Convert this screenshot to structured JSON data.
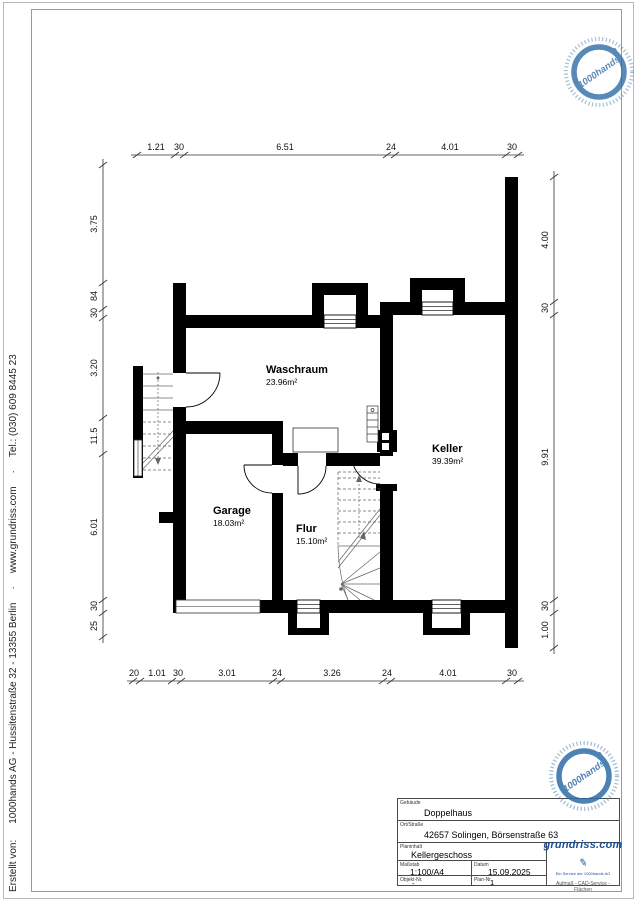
{
  "credit": {
    "prefix": "Erstellt von:",
    "company": "1000hands AG - Hussitenstraße 32 - 13355 Berlin",
    "sep": "·",
    "website": "www.grundriss.com",
    "phone": "Tel.: (030) 609 8445 23"
  },
  "rooms": [
    {
      "name": "Waschraum",
      "area": "23.96m²"
    },
    {
      "name": "Keller",
      "area": "39.39m²"
    },
    {
      "name": "Garage",
      "area": "18.03m²"
    },
    {
      "name": "Flur",
      "area": "15.10m²"
    }
  ],
  "dims": {
    "top": [
      "1.21",
      "30",
      "6.51",
      "24",
      "4.01",
      "30"
    ],
    "bottom": [
      "20",
      "1.01",
      "30",
      "3.01",
      "24",
      "3.26",
      "24",
      "4.01",
      "30"
    ],
    "left": [
      "3.75",
      "84",
      "30",
      "3.20",
      "11.5",
      "6.01",
      "30",
      "25"
    ],
    "right": [
      "4.00",
      "30",
      "9.91",
      "30",
      "1.00"
    ]
  },
  "titleblock": {
    "gebaeude_label": "Gebäude",
    "gebaeude": "Doppelhaus",
    "ort_label": "Ort/Straße",
    "ort": "42657 Solingen, Börsenstraße 63",
    "planinhalt_label": "Planinhalt",
    "planinhalt": "Kellergeschoss",
    "massstab_label": "Maßstab",
    "massstab": "1:100/A4",
    "datum_label": "Datum",
    "datum": "15.09.2025",
    "objekt_label": "Objekt-Nr.",
    "objekt": "-",
    "plan_label": "Plan-Nr.",
    "plan": "1"
  },
  "logo": {
    "name": "grundriss.com",
    "pen": "✎",
    "subtitle": "Ein Service der 1000hands AG",
    "tagline": "Aufmaß - CAD-Service - Flächen",
    "color": "#1b4f9e"
  },
  "stamp": {
    "text": "1000hands",
    "color": "#2f6da8"
  },
  "colors": {
    "wall": "#000000",
    "dimline": "#333333"
  }
}
